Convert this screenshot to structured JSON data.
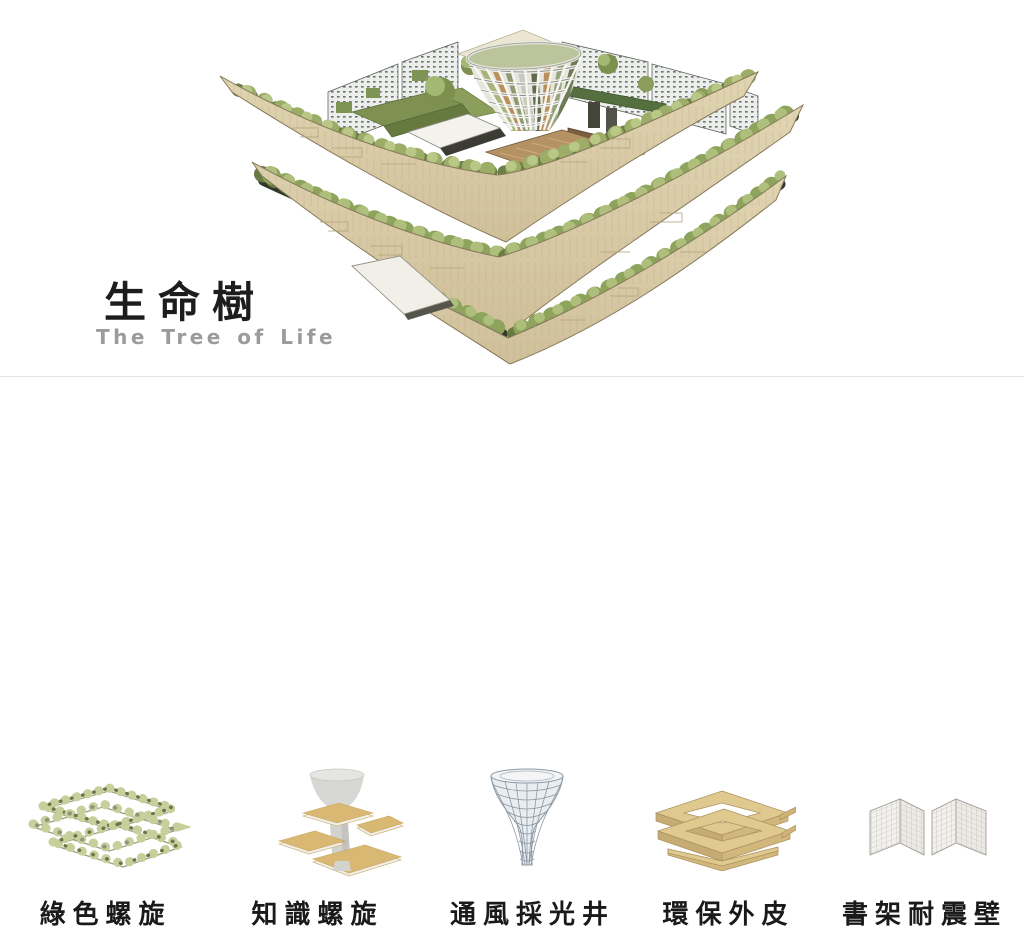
{
  "page": {
    "background": "#ffffff",
    "divider_color": "#e4e4e2"
  },
  "hero": {
    "title_zh": "生命樹",
    "title_en": "The Tree of Life",
    "title_color": "#1d1d1d",
    "subtitle_color": "#9b9b9b",
    "illustration": "aerial-axonometric-rendering-of-terraced-green-library-building",
    "colors": {
      "wood_band_light": "#e1d5b2",
      "wood_band_dark": "#cfc09a",
      "foliage": "#8ea35c",
      "foliage_light": "#b9c787",
      "foliage_dark": "#667a42",
      "shadow_recess": "#343a2b",
      "perforated_wall": "#eceeec",
      "green_roof": "#7e9150",
      "lawn": "#8b9e5b",
      "deck_wood": "#b59264",
      "funnel_structure": "#f4f4f0"
    }
  },
  "features": {
    "label_color": "#1a1a1a",
    "items": [
      {
        "label": "綠色螺旋",
        "icon": "green-spiral-diagram"
      },
      {
        "label": "知識螺旋",
        "icon": "knowledge-spiral-diagram"
      },
      {
        "label": "通風採光井",
        "icon": "ventilation-daylight-well-diagram"
      },
      {
        "label": "環保外皮",
        "icon": "eco-skin-diagram"
      },
      {
        "label": "書架耐震壁",
        "icon": "bookshelf-seismic-wall-diagram"
      }
    ]
  }
}
